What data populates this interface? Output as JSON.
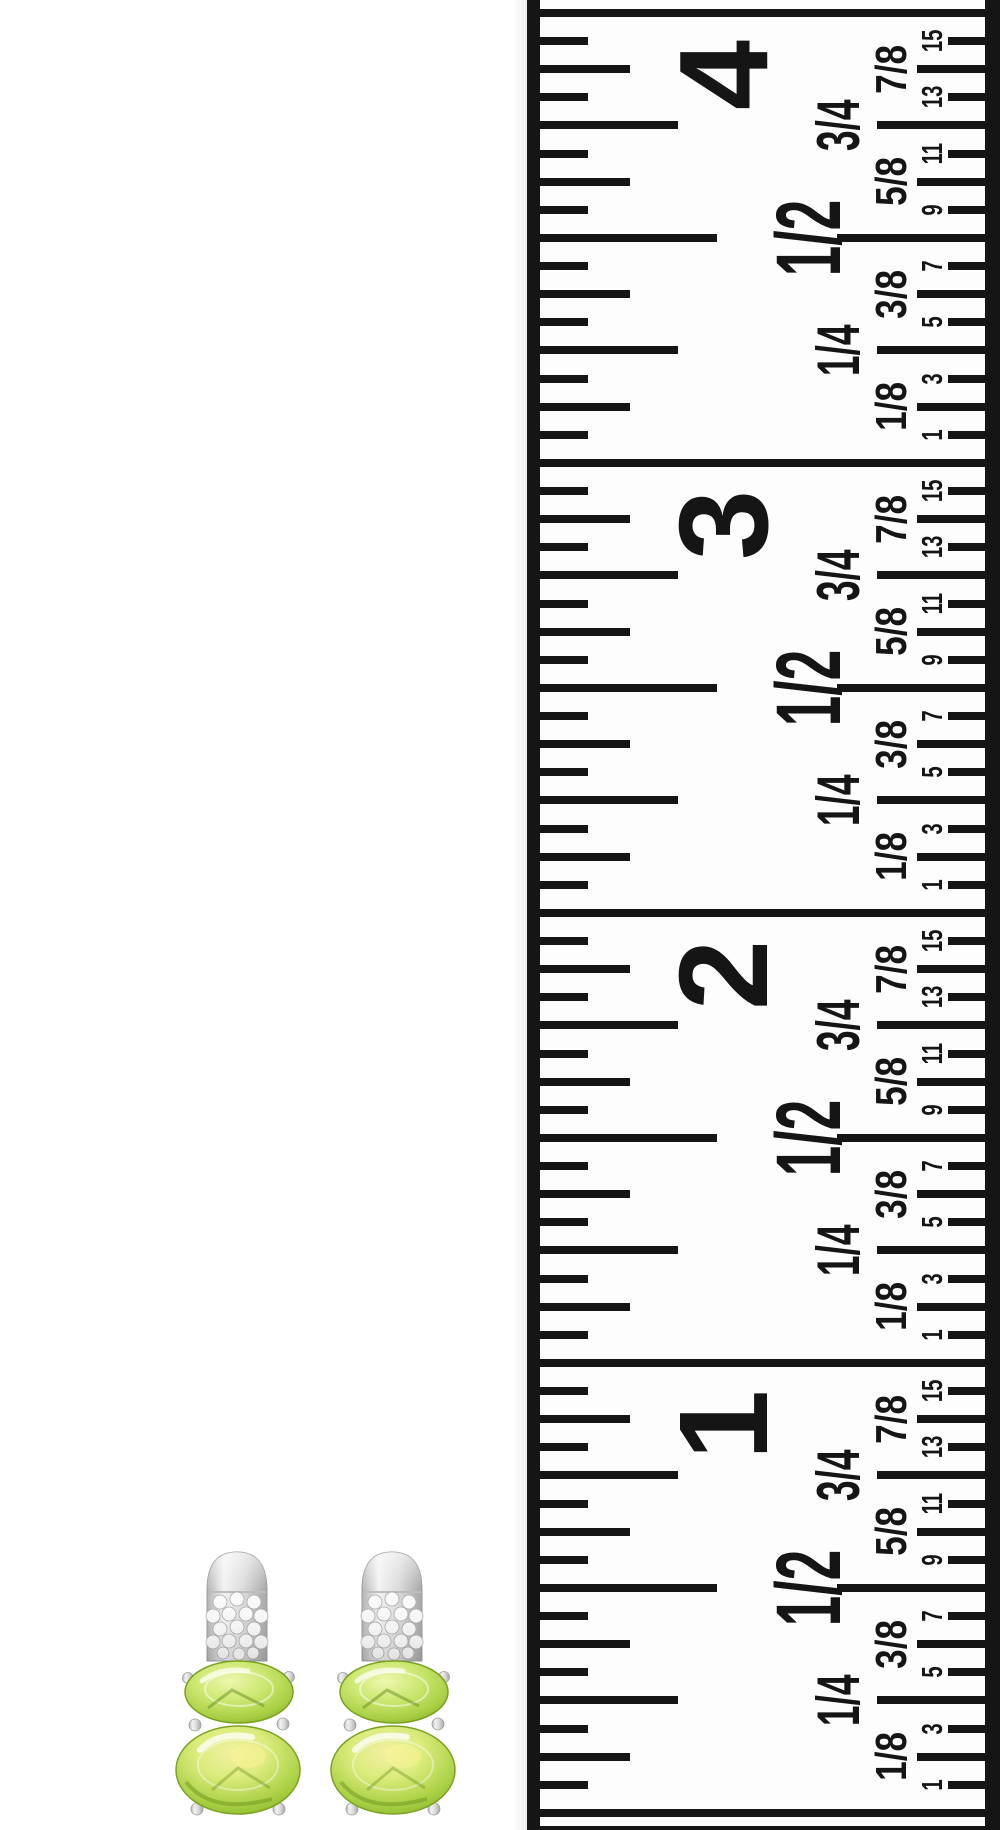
{
  "scene": {
    "background_color": "#ffffff",
    "description_colors": {
      "tape_ink": "#151515",
      "tape_face": "#fdfdfd"
    }
  },
  "ruler": {
    "unit": "inches",
    "inch_labels": [
      "1",
      "2",
      "3",
      "4"
    ],
    "half_label": "1/2",
    "quarter_labels": [
      "1/4",
      "3/4"
    ],
    "eighth_labels": [
      "1/8",
      "3/8",
      "5/8",
      "7/8"
    ],
    "sixteenth_labels": [
      "1",
      "3",
      "5",
      "7",
      "9",
      "11",
      "13",
      "15"
    ],
    "ink_color": "#151515",
    "face_color": "#fdfdfd"
  },
  "earrings": {
    "stone_color": "#a8cf42",
    "stone_highlight_color": "#eef7b0",
    "stone_rim_color": "#6f9c1c",
    "metal_color": "#d9d9d9",
    "metal_highlight_color": "#f2f2f2"
  }
}
